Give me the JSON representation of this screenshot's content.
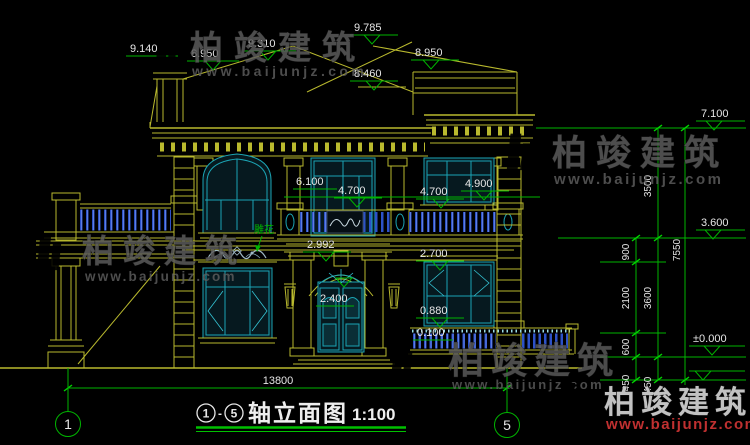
{
  "drawing_title": {
    "axis_start": "1",
    "separator": "-",
    "axis_end": "5",
    "name": "轴立面图",
    "scale": "1:100"
  },
  "axis_bubbles": {
    "left": "1",
    "right": "5"
  },
  "levels": {
    "top_left": "9.140",
    "parapet_left": "8.950",
    "ridge_mid": "9.310",
    "ridge_top": "9.785",
    "roof_step": "8.460",
    "parapet_right": "8.950",
    "eave": "7.100",
    "second_floor": "3.600",
    "zero": "±0.000",
    "balcony_door_head": "6.100",
    "level_4700_a": "4.700",
    "level_4700_b": "4.700",
    "level_4900": "4.900",
    "porch_top": "2.992",
    "window_head": "2.700",
    "door_height": "2.400",
    "window_sill": "0.880",
    "terrace": "0.100"
  },
  "dims": {
    "v3500": "3500",
    "v900": "900",
    "v2100": "2100",
    "v3600": "3600",
    "v7550": "7550",
    "v600": "600",
    "v450a": "450",
    "v450b": "450",
    "h13800": "13800"
  },
  "callout": {
    "carving": "雕花"
  },
  "watermark": {
    "brand": "柏竣建筑",
    "url": "www.baijunjz.com"
  },
  "colors": {
    "background": "#000000",
    "cad_yellow": "#b9b92e",
    "cad_cyan": "#1ba4b4",
    "dim_green": "#00b400",
    "text_white": "#e6e6e6",
    "railing_blue": "#2d52c8",
    "watermark_gray": "#5e5e5e",
    "logo_orange": "#f0861c",
    "logo_blue": "#1d55c0",
    "url_red": "#c03030"
  }
}
